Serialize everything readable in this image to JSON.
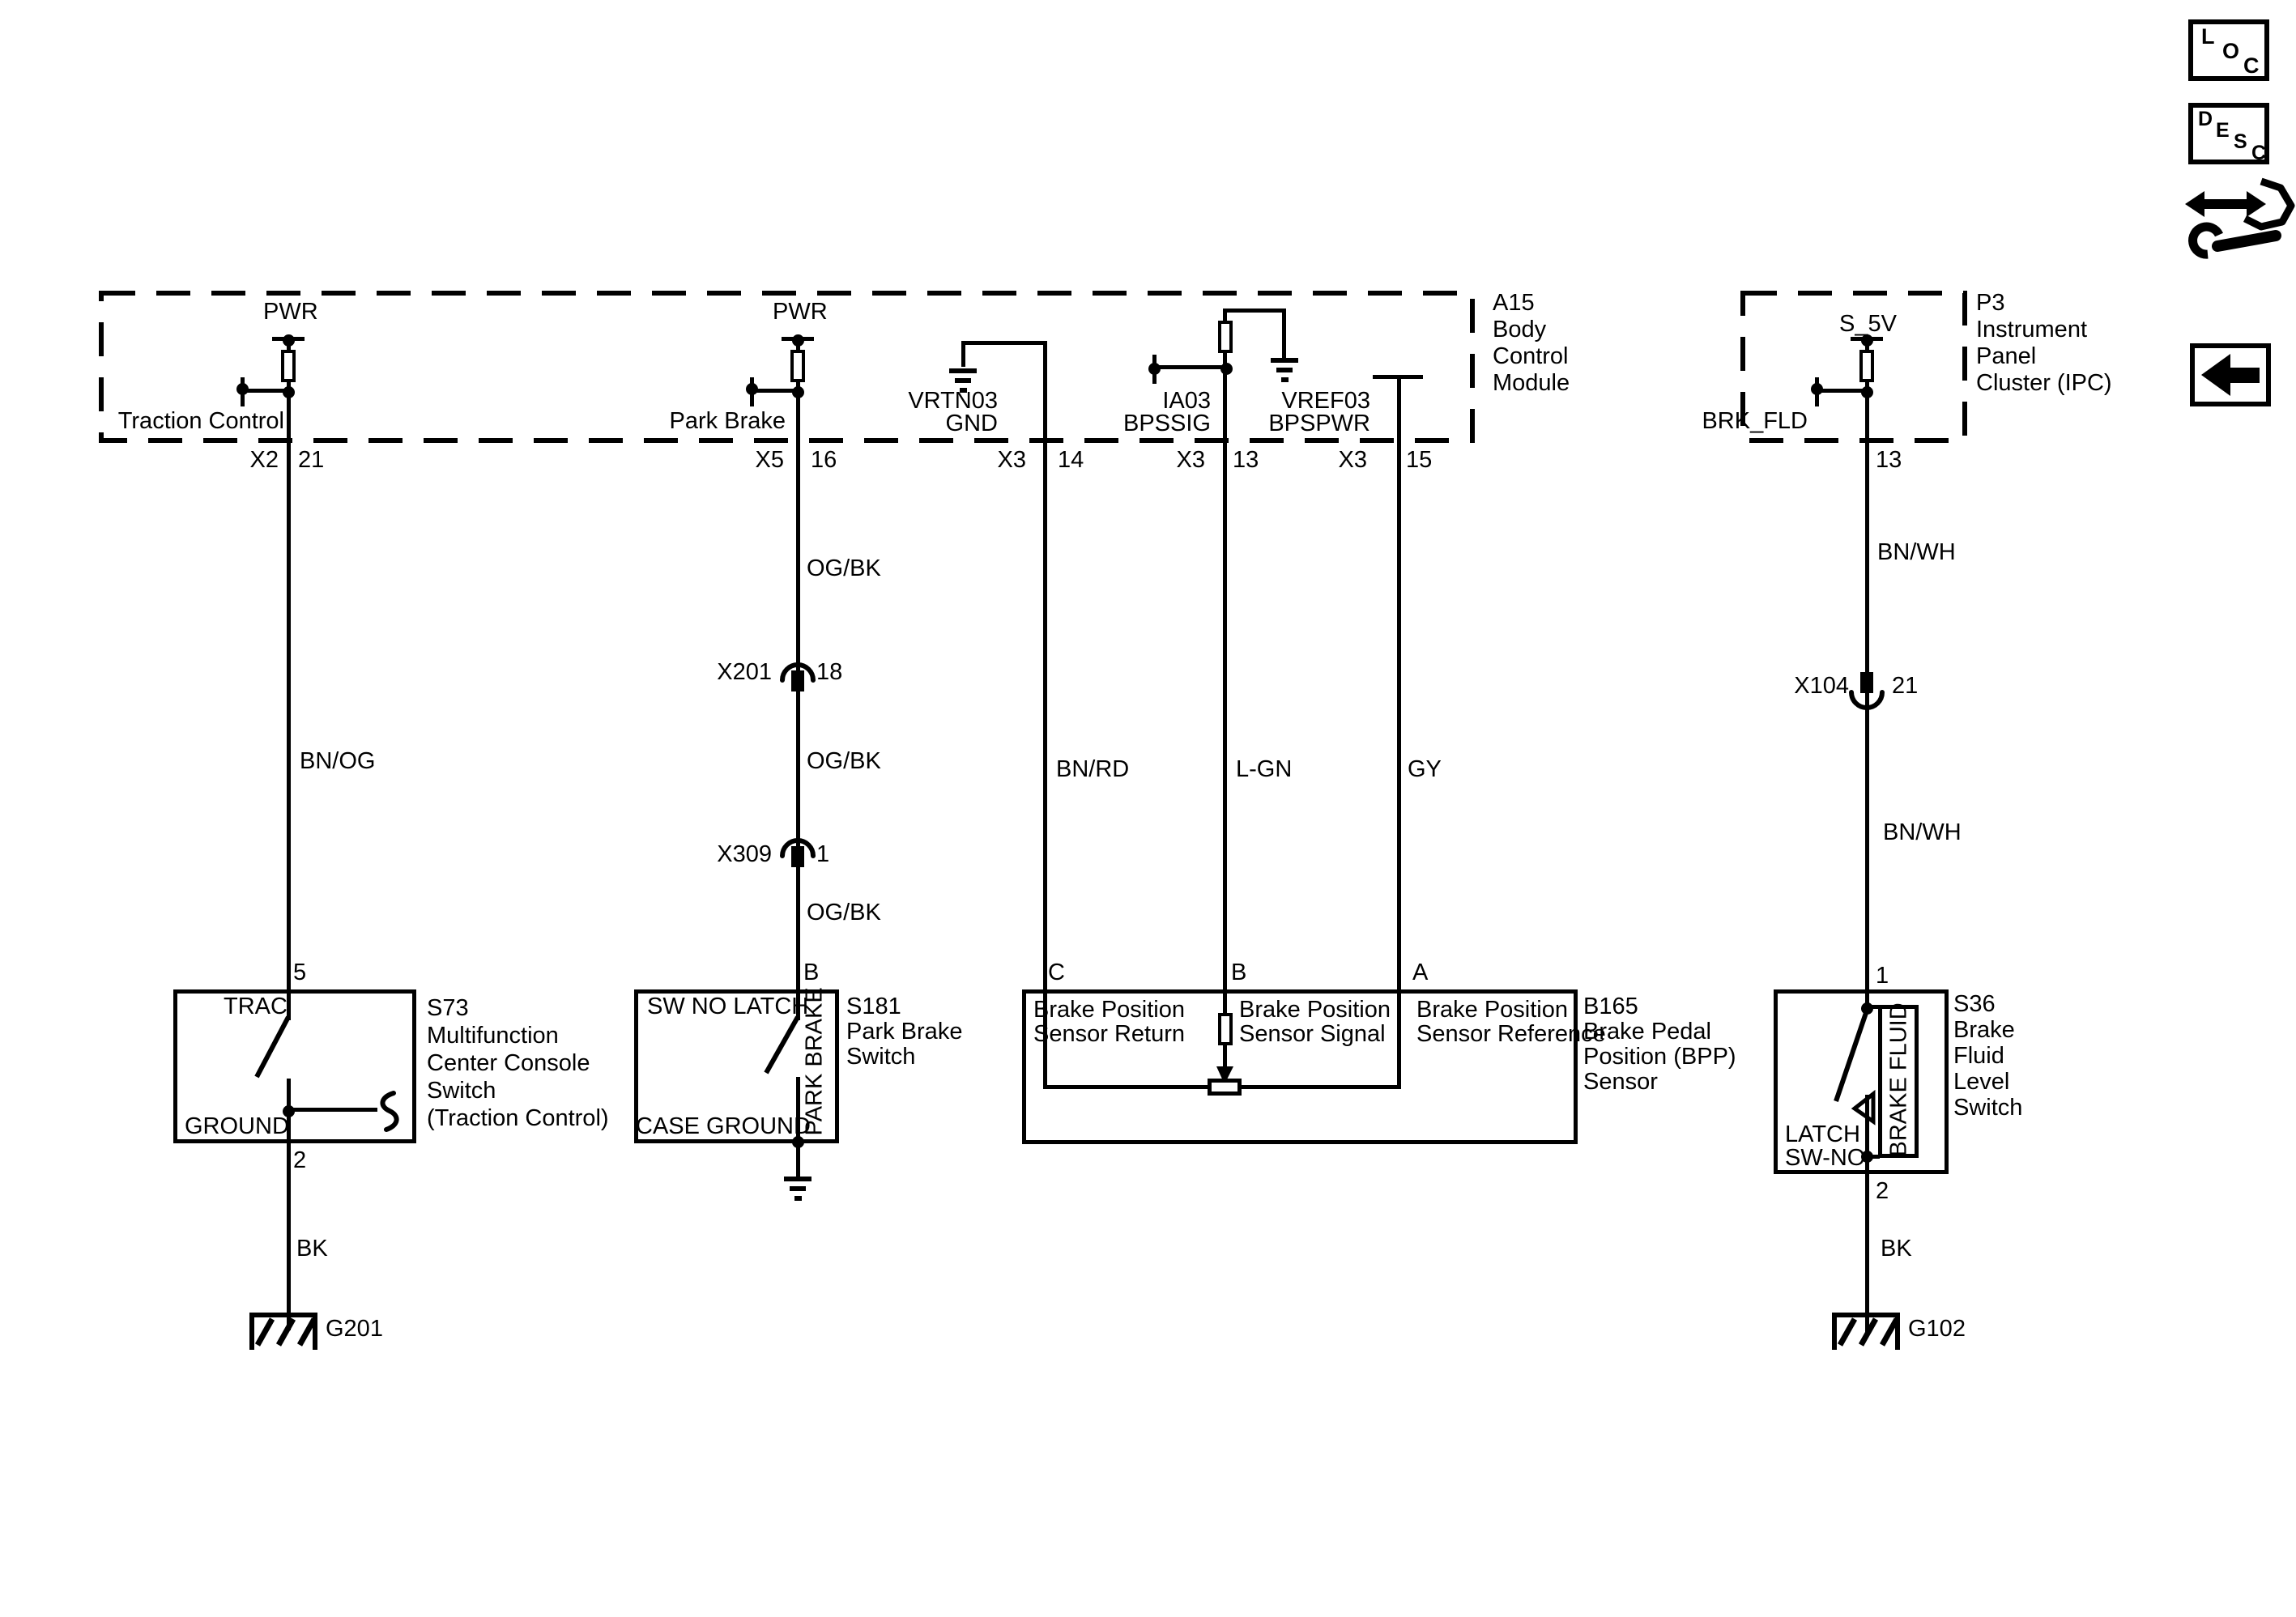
{
  "colors": {
    "line": "#000000",
    "background": "#ffffff"
  },
  "bcm": {
    "id_lines": [
      "A15",
      "Body",
      "Control",
      "Module"
    ]
  },
  "ipc": {
    "id_lines": [
      "P3",
      "Instrument",
      "Panel",
      "Cluster (IPC)"
    ]
  },
  "traction": {
    "pwr": "PWR",
    "name": "Traction Control",
    "conn": "X2",
    "conn_pin": "21",
    "wire_color": "BN/OG",
    "sw_pin_top": "5",
    "sw_pin_bottom": "2",
    "wire_color2": "BK",
    "ground": "G201",
    "switch": {
      "id_lines": [
        "S73",
        "Multifunction",
        "Center Console",
        "Switch",
        "(Traction Control)"
      ],
      "contact_top": "TRAC",
      "contact_bottom": "GROUND"
    }
  },
  "park_brake": {
    "pwr": "PWR",
    "name": "Park Brake",
    "conn": "X5",
    "conn_pin": "16",
    "wire_color1": "OG/BK",
    "splice1": "X201",
    "splice1_pin": "18",
    "wire_color2": "OG/BK",
    "splice2": "X309",
    "splice2_pin": "1",
    "wire_color3": "OG/BK",
    "sw_pin_top": "B",
    "switch": {
      "id_lines": [
        "S181",
        "Park Brake",
        "Switch"
      ],
      "contact_top": "SW NO LATCH",
      "contact_bottom": "CASE GROUND",
      "vertical_label": "PARK BRAKE"
    }
  },
  "vrtn": {
    "net": "VRTN03",
    "func": "GND",
    "conn": "X3",
    "conn_pin": "14",
    "wire_color": "BN/RD",
    "sensor_pin": "C"
  },
  "ia03": {
    "net": "IA03",
    "func": "BPSSIG",
    "conn": "X3",
    "conn_pin": "13",
    "wire_color": "L-GN",
    "sensor_pin": "B"
  },
  "vref": {
    "net": "VREF03",
    "func": "BPSPWR",
    "conn": "X3",
    "conn_pin": "15",
    "wire_color": "GY",
    "sensor_pin": "A"
  },
  "bpp": {
    "id_lines": [
      "B165",
      "Brake Pedal",
      "Position (BPP)",
      "Sensor"
    ],
    "return_lines": [
      "Brake Position",
      "Sensor Return"
    ],
    "signal_lines": [
      "Brake Position",
      "Sensor Signal"
    ],
    "reference_lines": [
      "Brake Position",
      "Sensor Reference"
    ]
  },
  "ipc_branch": {
    "s5v": "S_5V",
    "name": "BRK_FLD",
    "conn_pin": "13",
    "wire_color1": "BN/WH",
    "splice": "X104",
    "splice_pin": "21",
    "wire_color2": "BN/WH",
    "sw_pin_top": "1",
    "sw_pin_bottom": "2",
    "wire_color3": "BK",
    "ground": "G102",
    "switch": {
      "id_lines": [
        "S36",
        "Brake",
        "Fluid",
        "Level",
        "Switch"
      ],
      "latch": "LATCH",
      "swno": "SW-NO",
      "vertical_label": "BRAKE FLUID"
    }
  },
  "corner_icons": {
    "loc": [
      "L",
      "O",
      "C"
    ],
    "desc": [
      "D",
      "E",
      "S",
      "C"
    ]
  }
}
